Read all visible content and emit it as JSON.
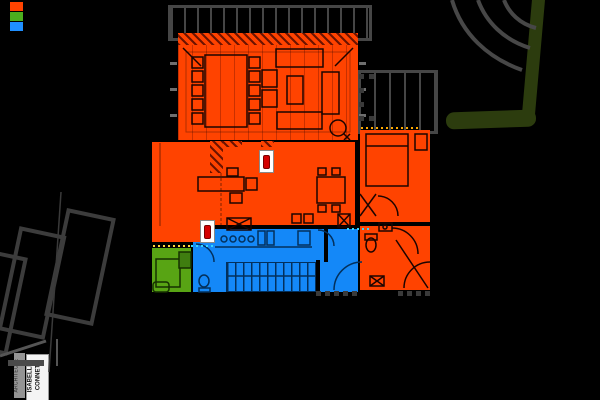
{
  "legend": {
    "swatches": [
      {
        "name": "day-zone",
        "color": "#ff4300"
      },
      {
        "name": "terrace-zone",
        "color": "#4cae1e"
      },
      {
        "name": "service-zone",
        "color": "#1f8fff"
      }
    ]
  },
  "plan": {
    "colors": {
      "day_zone": "#ff4300",
      "service_zone": "#1488f8",
      "terrace": "#58a414",
      "hedge": "#2c3c0e",
      "structure": "#4a4a4a",
      "parking_outline": "#3c3c3c",
      "background": "#000000",
      "window_dots_yellow": "#ffd83a",
      "window_dots_cyan": "#35d6ff",
      "window_dots_orange": "#ffaa00"
    }
  },
  "title_block": {
    "role": "ARCHITECTE",
    "name": "ISABELLE CONNET"
  }
}
